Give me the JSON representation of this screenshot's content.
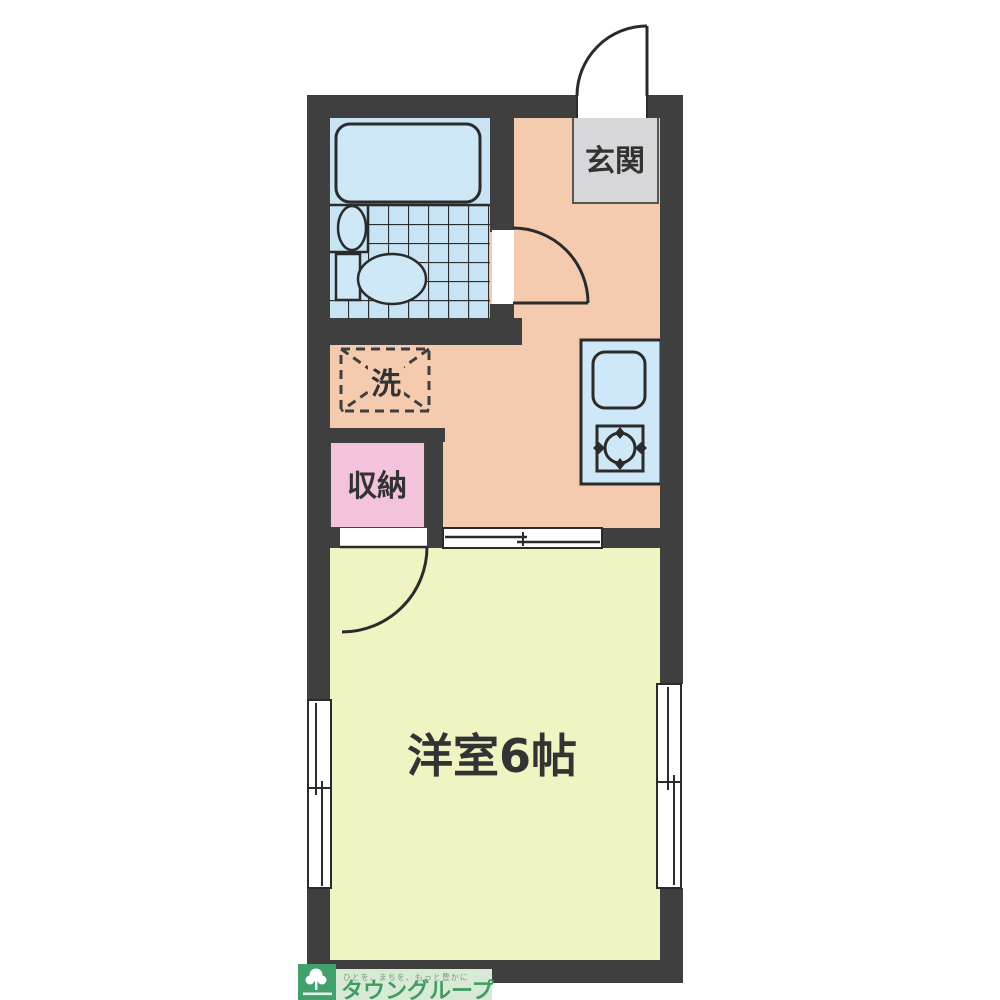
{
  "floorplan": {
    "rooms": {
      "entrance": {
        "label": "玄関"
      },
      "washer": {
        "label": "洗"
      },
      "storage": {
        "label": "収納"
      },
      "main_room": {
        "label": "洋室6帖"
      }
    },
    "colors": {
      "wall": "#3f3f3f",
      "hallway_floor": "#f4cbae",
      "main_room_floor": "#f0f4c3",
      "bathroom_floor": "#c8e4f4",
      "fixture_blue": "#cfe8f7",
      "storage_pink": "#f2c3da",
      "entrance_gray": "#d7d7d9",
      "kitchen_counter": "#c8e4f4",
      "outline": "#2b2b2b"
    }
  },
  "footer_logo": {
    "slogan": "ひとを、まちを、もっと豊かに",
    "brand": "タウングループ",
    "brand_color": "#3f9d60",
    "logo_square_color": "#42a06b",
    "band_color": "#d8ead6"
  }
}
